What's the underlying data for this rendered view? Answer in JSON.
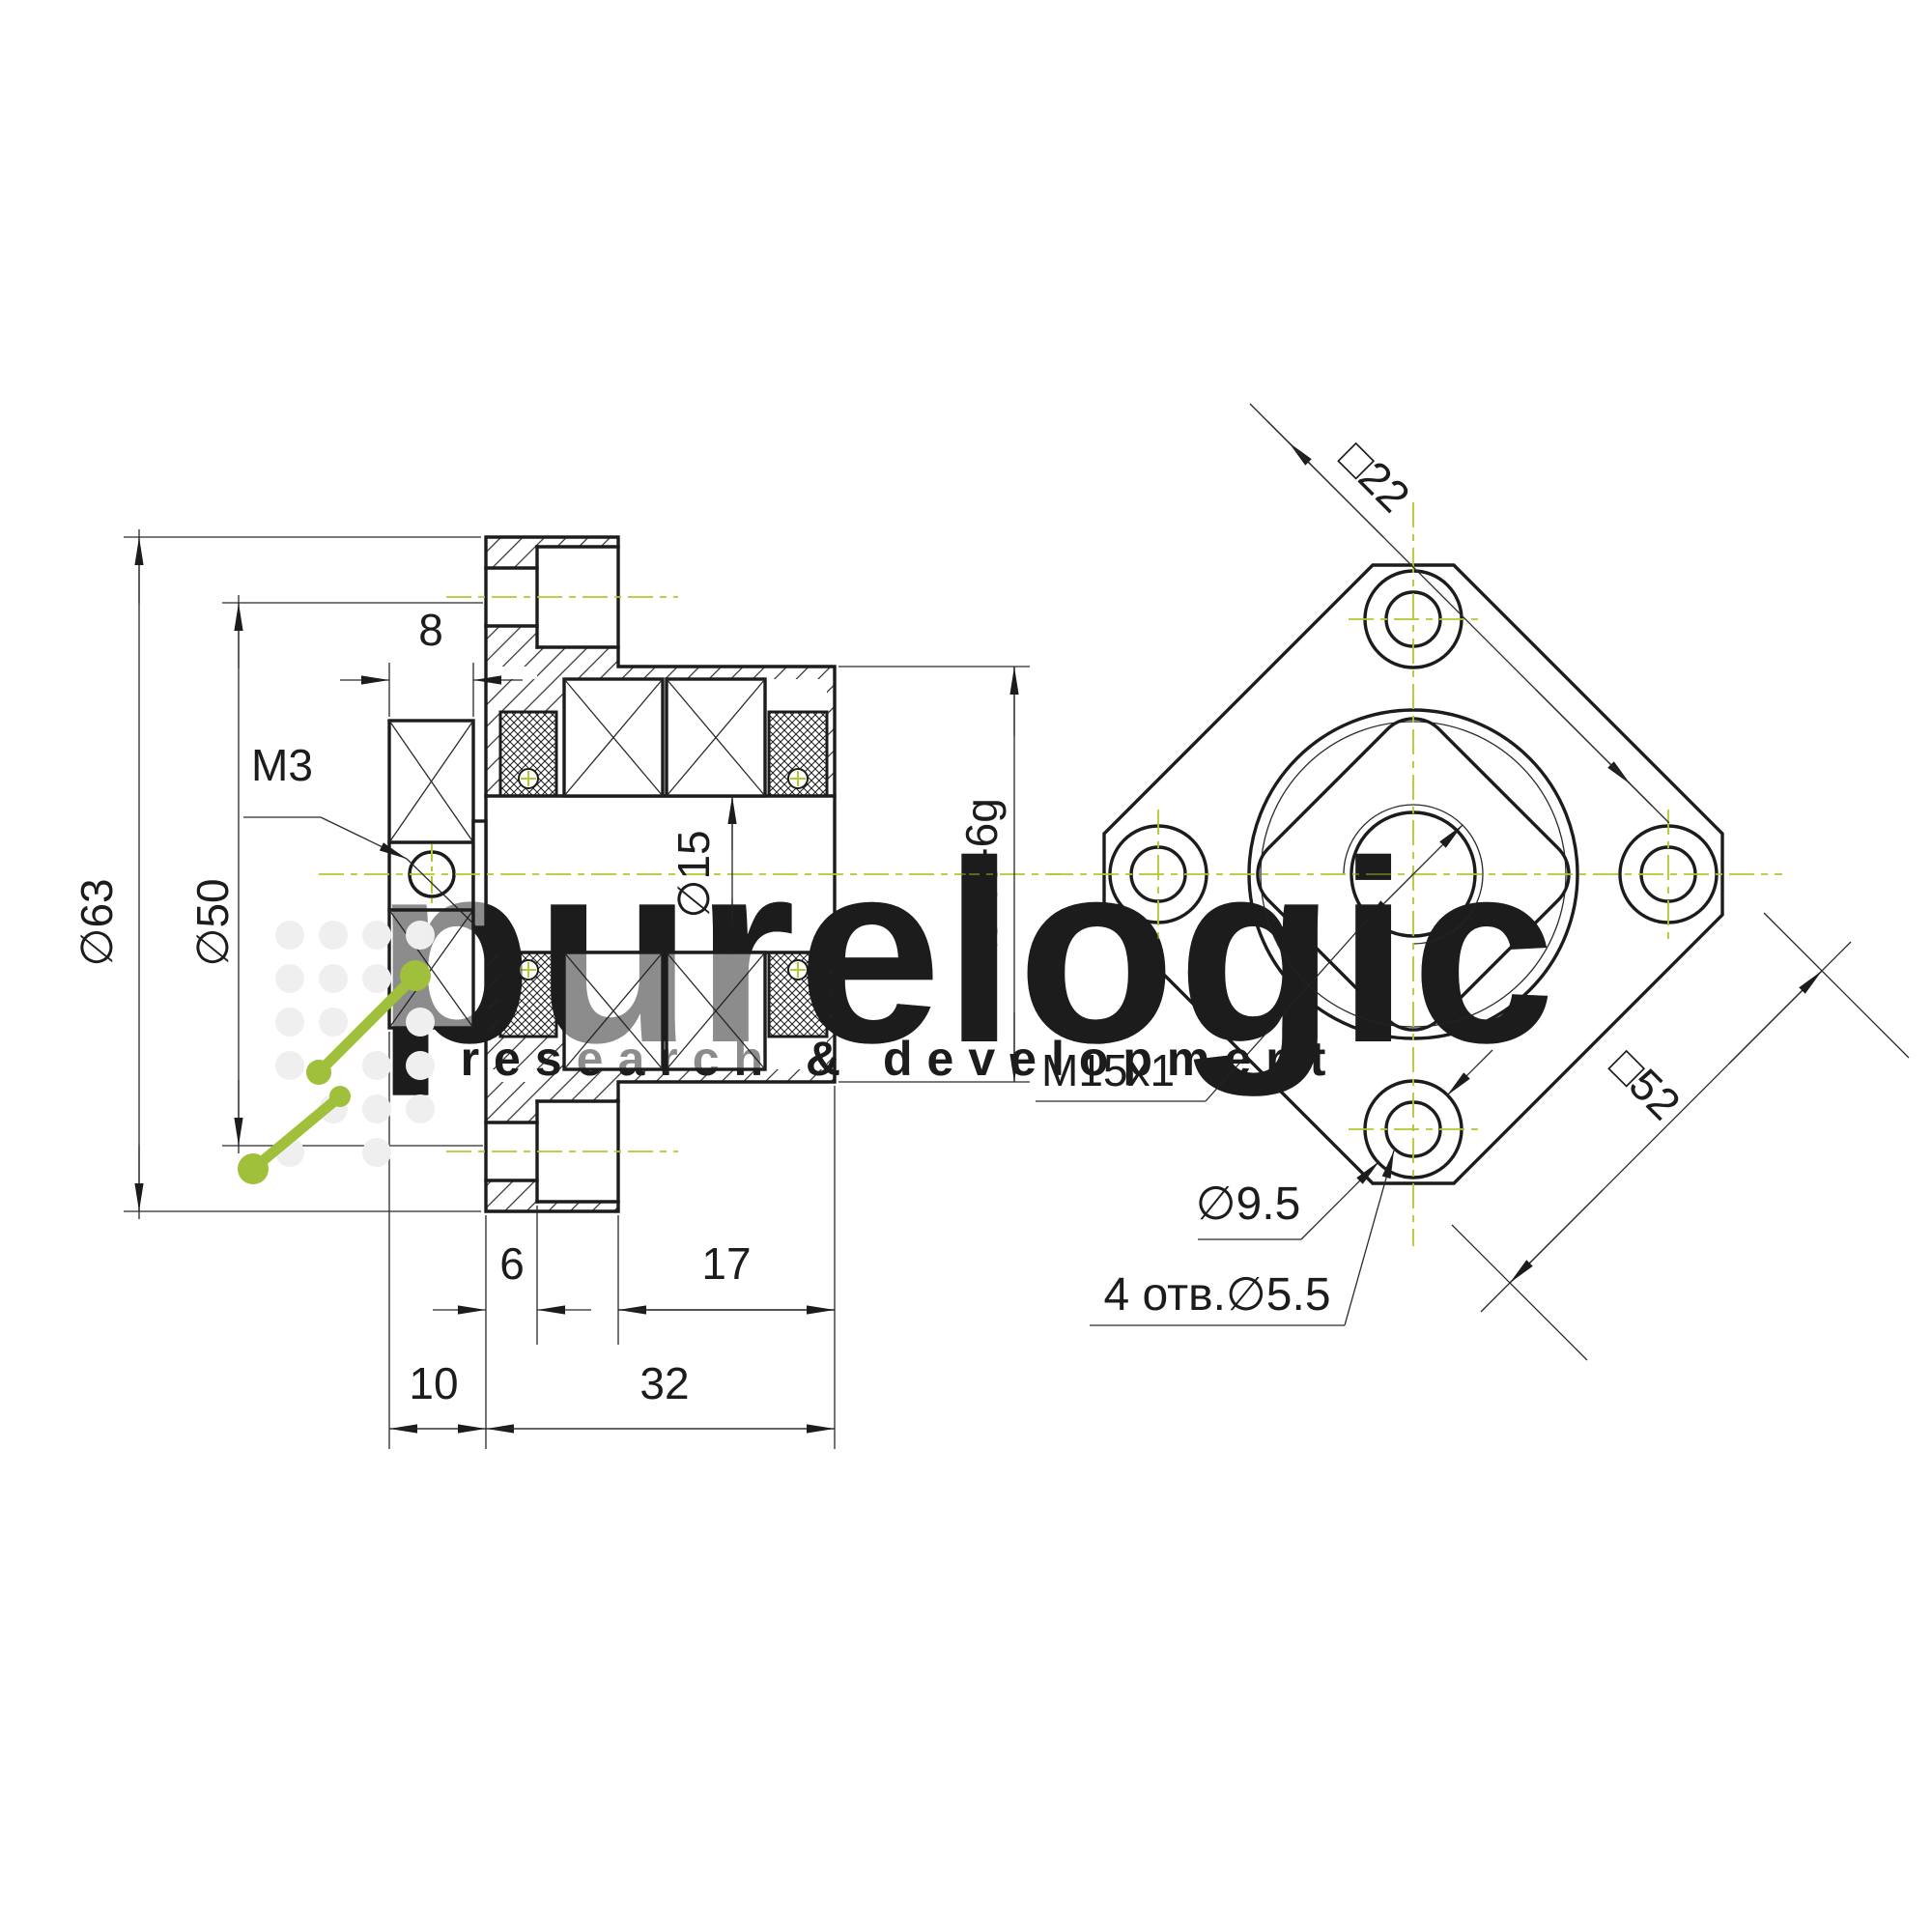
{
  "drawing": {
    "title": "flanged ballscrew bearing support – 2-view engineering drawing",
    "section_view": {
      "dia63": "∅63",
      "dia50": "∅50",
      "width8": "8",
      "thread_m3": "M3",
      "dia15": "∅15",
      "dia40": "∅40-6g",
      "len6": "6",
      "len17": "17",
      "len10": "10",
      "len32": "32"
    },
    "front_view": {
      "square22": "□22",
      "square52": "□52",
      "thread_m15": "M15x1",
      "dia95": "∅9.5",
      "holes": "4 отв.∅5.5"
    },
    "watermark": {
      "line1": "purelogic",
      "line2": "research & development"
    },
    "colors": {
      "line": "#1c1c1c",
      "centerline": "#b5c732",
      "watermark": "#ebebeb",
      "logo_green": "#a0bf3b"
    }
  }
}
